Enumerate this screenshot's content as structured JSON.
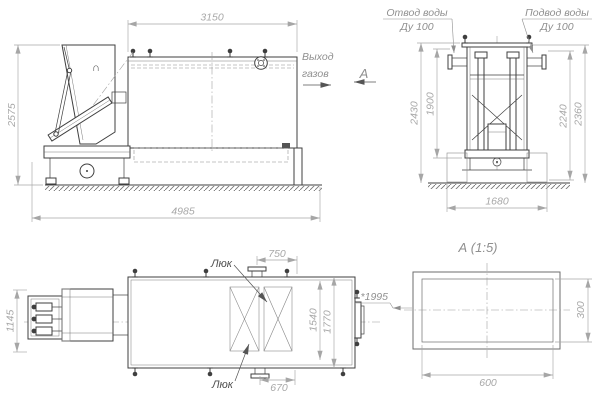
{
  "colors": {
    "background": "#ffffff",
    "outline": "#3f3f3f",
    "dimension_line": "#a6a6a6",
    "dimension_text": "#a8a8a8",
    "label_text": "#8f8f8f",
    "dark_label_text": "#4f4f4f"
  },
  "side_view": {
    "dim_top": "3150",
    "dim_left": "2575",
    "dim_bottom": "4985",
    "gas_outlet_line1": "Выход",
    "gas_outlet_line2": "газов",
    "view_arrow_label": "А",
    "hopper_mark": "∩"
  },
  "end_view": {
    "outlet_label_line1": "Отвод воды",
    "outlet_label_line2": "Ду 100",
    "supply_label_line1": "Подвод воды",
    "supply_label_line2": "Ду 100",
    "dim_left_outer": "2430",
    "dim_left_inner": "1900",
    "dim_right_inner": "2240",
    "dim_right_outer": "2360",
    "dim_bottom": "1680"
  },
  "top_view": {
    "dim_left": "1145",
    "dim_top": "750",
    "dim_bottom": "670",
    "dim_inner_height": "1540",
    "dim_outer_height": "1770",
    "hatch_label_top": "Люк",
    "hatch_label_bottom": "Люк"
  },
  "section_view": {
    "title": "А  (1:5)",
    "ref_dim": "*1995",
    "dim_width": "600",
    "dim_height": "300"
  }
}
